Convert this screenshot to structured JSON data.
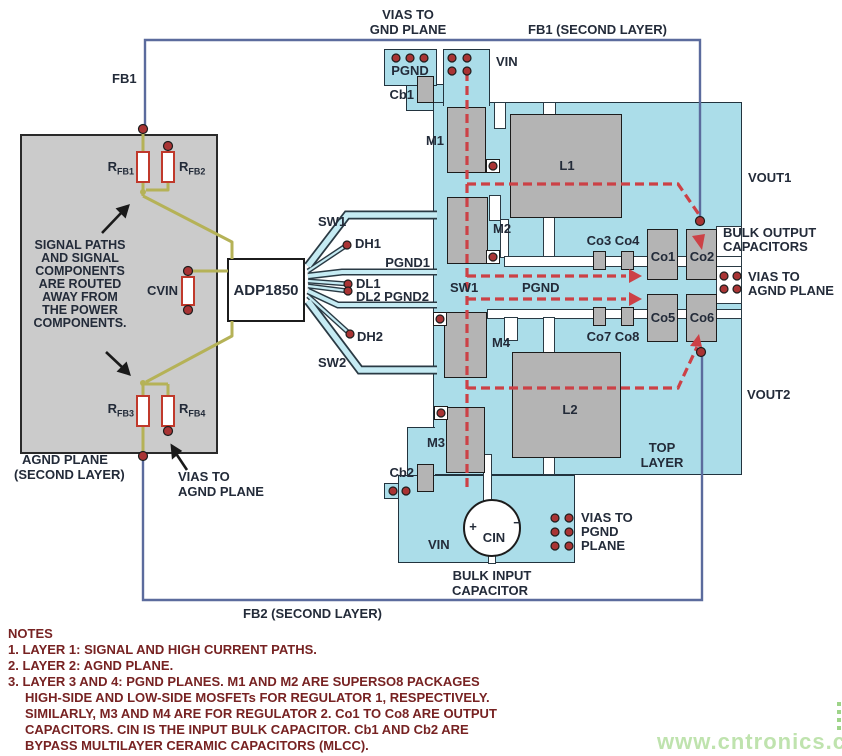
{
  "labels": {
    "vias_gnd_1": "VIAS TO",
    "vias_gnd_2": "GND PLANE",
    "fb1_second": "FB1 (SECOND LAYER)",
    "fb1": "FB1",
    "pgnd_pad": "PGND",
    "cb1": "Cb1",
    "vin_top": "VIN",
    "m1": "M1",
    "m2": "M2",
    "m3": "M3",
    "m4": "M4",
    "l1": "L1",
    "l2": "L2",
    "r_fb1": {
      "base": "R",
      "sub": "FB1"
    },
    "r_fb2": {
      "base": "R",
      "sub": "FB2"
    },
    "r_fb3": {
      "base": "R",
      "sub": "FB3"
    },
    "r_fb4": {
      "base": "R",
      "sub": "FB4"
    },
    "cvin": "CVIN",
    "chip": "ADP1850",
    "sw1_trace": "SW1",
    "dh1": "DH1",
    "pgnd1": "PGND1",
    "dl1": "DL1",
    "dl2_pgnd2": "DL2 PGND2",
    "dh2": "DH2",
    "sw2_trace": "SW2",
    "corridor_sw1": "SW1",
    "corridor_pgnd": "PGND",
    "co34": "Co3 Co4",
    "co78": "Co7 Co8",
    "co1": "Co1",
    "co2": "Co2",
    "co5": "Co5",
    "co6": "Co6",
    "vout1": "VOUT1",
    "vout2": "VOUT2",
    "bulk_out_1": "BULK OUTPUT",
    "bulk_out_2": "CAPACITORS",
    "vias_agnd_r1": "VIAS TO",
    "vias_agnd_r2": "AGND PLANE",
    "top_layer_1": "TOP",
    "top_layer_2": "LAYER",
    "agnd_plane_1": "AGND PLANE",
    "agnd_plane_2": "(SECOND LAYER)",
    "vias_agnd_l1": "VIAS TO",
    "vias_agnd_l2": "AGND PLANE",
    "cb2": "Cb2",
    "vin_bottom": "VIN",
    "cin": "CIN",
    "plus": "+",
    "minus": "−",
    "vias_pgnd_1": "VIAS TO",
    "vias_pgnd_2": "PGND",
    "vias_pgnd_3": "PLANE",
    "bulk_in_1": "BULK INPUT",
    "bulk_in_2": "CAPACITOR",
    "fb2_second": "FB2 (SECOND LAYER)"
  },
  "signal_note_lines": [
    "SIGNAL PATHS",
    "AND SIGNAL",
    "COMPONENTS",
    "ARE ROUTED",
    "AWAY FROM",
    "THE POWER",
    "COMPONENTS."
  ],
  "notes": {
    "lines": [
      "NOTES",
      "1. LAYER 1: SIGNAL AND HIGH CURRENT PATHS.",
      "2. LAYER 2: AGND PLANE.",
      "3. LAYER 3 AND 4: PGND PLANES. M1 AND M2 ARE SUPERSO8 PACKAGES",
      "HIGH-SIDE AND LOW-SIDE MOSFETs FOR REGULATOR 1, RESPECTIVELY.",
      "SIMILARLY, M3 AND M4 ARE FOR REGULATOR 2. Co1 TO Co8 ARE OUTPUT",
      "CAPACITORS. CIN IS THE INPUT BULK CAPACITOR. Cb1 AND Cb2 ARE",
      "BYPASS MULTILAYER CERAMIC CAPACITORS (MLCC)."
    ]
  },
  "watermark": "www.cntronics.com",
  "colors": {
    "plane_cyan": "#abdde9",
    "component_gray": "#b4b4b4",
    "feedback_blue": "#5b6b9d",
    "signal_olive": "#b5b257",
    "route_red": "#cc4146",
    "via_red": "#a93434",
    "label_dark": "#232b39",
    "notes_maroon": "#772222",
    "watermark_green": "#bfe3ae"
  }
}
